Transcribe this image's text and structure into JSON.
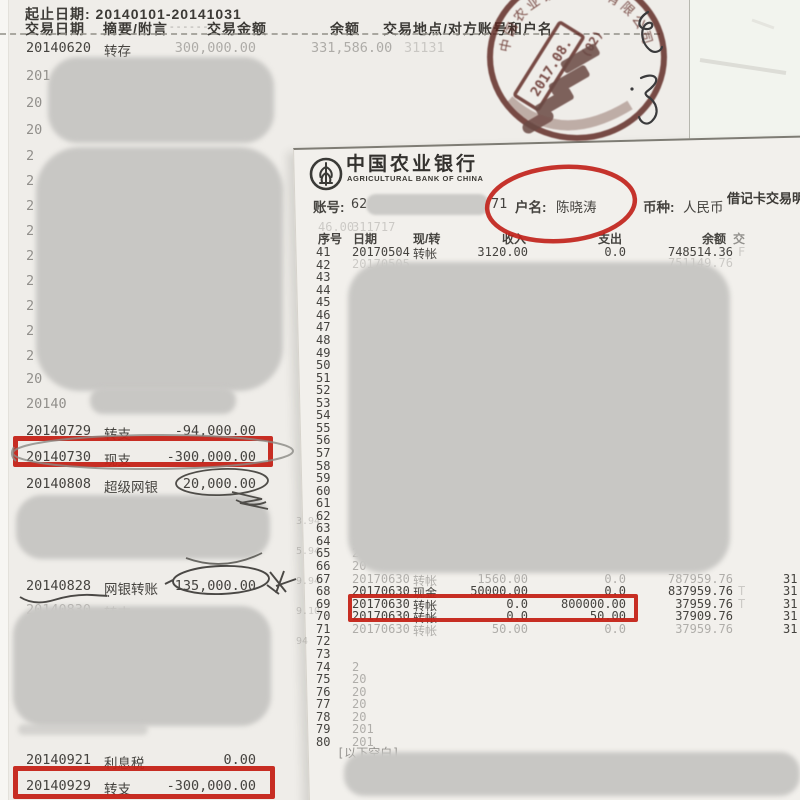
{
  "colors": {
    "annotation_red": "#c42318",
    "stamp_red": "#5a241d",
    "redaction_gray": "#c8c7c4"
  },
  "statement_2014": {
    "period_line": "起止日期: 20140101-20141031",
    "columns": [
      "交易日期",
      "摘要/附言",
      "交易金额",
      "余额",
      "交易地点/对方账号和户名"
    ],
    "header_dashes": "- - - - - -",
    "first_row": {
      "date": "20140620",
      "type": "转存",
      "amount": "300,000.00",
      "balance": "331,586.00",
      "ghost_tail": "31131"
    },
    "ghost_fragments": [
      "201",
      "20",
      "20",
      "2",
      "2",
      "2",
      "2",
      "2",
      "2",
      "2",
      "2",
      "2",
      "20",
      "20140"
    ],
    "transactions": [
      {
        "date": "20140729",
        "type": "转支",
        "amount": "-94,000.00",
        "faint": false
      },
      {
        "date": "20140730",
        "type": "现支",
        "amount": "-300,000.00",
        "faint": false
      },
      {
        "date": "20140808",
        "type": "超级网银",
        "amount": "20,000.00",
        "faint": false
      },
      {
        "date": "20140828",
        "type": "网银转账",
        "amount": "135,000.00",
        "faint": false
      },
      {
        "date": "20140830",
        "type": "转支",
        "amount": "",
        "faint": true
      },
      {
        "date": "20140921",
        "type": "利息税",
        "amount": "0.00",
        "faint": false
      },
      {
        "date": "20140929",
        "type": "转支",
        "amount": "-300,000.00",
        "faint": false
      }
    ]
  },
  "abc_statement": {
    "bank_name_cn": "中国农业银行",
    "bank_name_en": "AGRICULTURAL BANK OF CHINA",
    "doc_title": "借记卡交易明细",
    "account_label": "账号:",
    "account_visible_prefix": "62",
    "account_visible_suffix": "71",
    "holder_label": "户名:",
    "holder_name": "陈晓涛",
    "currency_label": "币种:",
    "currency": "人民币",
    "table_columns": [
      "序号",
      "日期",
      "现/转",
      "收入",
      "支出",
      "余额",
      "交"
    ],
    "row_number_range": [
      41,
      80
    ],
    "transactions": [
      {
        "no": 41,
        "date": "20170504",
        "type": "转帐",
        "income": "3120.00",
        "expense": "0.0",
        "balance": "748514.36",
        "tail": "F",
        "edge": "",
        "faint": false,
        "boxed": false
      },
      {
        "no": 67,
        "date": "20170630",
        "type": "转帐",
        "income": "1560.00",
        "expense": "0.0",
        "balance": "787959.76",
        "tail": "",
        "edge": "31",
        "faint": true,
        "boxed": false
      },
      {
        "no": 68,
        "date": "20170630",
        "type": "现金",
        "income": "50000.00",
        "expense": "0.0",
        "balance": "837959.76",
        "tail": "T",
        "edge": "31",
        "faint": false,
        "boxed": false
      },
      {
        "no": 69,
        "date": "20170630",
        "type": "转帐",
        "income": "0.0",
        "expense": "800000.00",
        "balance": "37959.76",
        "tail": "T",
        "edge": "31",
        "faint": false,
        "boxed": true
      },
      {
        "no": 70,
        "date": "20170630",
        "type": "转帐",
        "income": "0.0",
        "expense": "50.00",
        "balance": "37909.76",
        "tail": "",
        "edge": "31",
        "faint": false,
        "boxed": false
      },
      {
        "no": 71,
        "date": "20170630",
        "type": "转帐",
        "income": "50.00",
        "expense": "0.0",
        "balance": "37959.76",
        "tail": "",
        "edge": "31",
        "faint": true,
        "boxed": false
      }
    ],
    "ghost_row42": {
      "date": "20170505",
      "balance": "751149.76"
    },
    "date_fragments": {
      "63": "2",
      "64": "2",
      "65": "2",
      "66": "20",
      "74": "2",
      "75": "20",
      "76": "20",
      "77": "20",
      "78": "20",
      "79": "201",
      "80": "201"
    },
    "footer_note": "[以下空白]",
    "bleed_numbers": [
      "3.94",
      "5.94",
      "9.94",
      "9.10",
      "94"
    ],
    "bleed_under_account": [
      "46.00",
      "311717"
    ]
  },
  "stamp": {
    "date_text": "2017.08.",
    "code_text": "(02)",
    "ring_text": "中国农业银行股份有限公司"
  },
  "annotations": {
    "red_circle_target": "户名: 陈晓涛",
    "red_box_targets": [
      "20140730 现支 -300,000.00",
      "20140929 转支 -300,000.00",
      "20170630 转帐 0.0 800000.00"
    ],
    "pen_circle_targets": [
      "20,000.00",
      "135,000.00"
    ]
  }
}
